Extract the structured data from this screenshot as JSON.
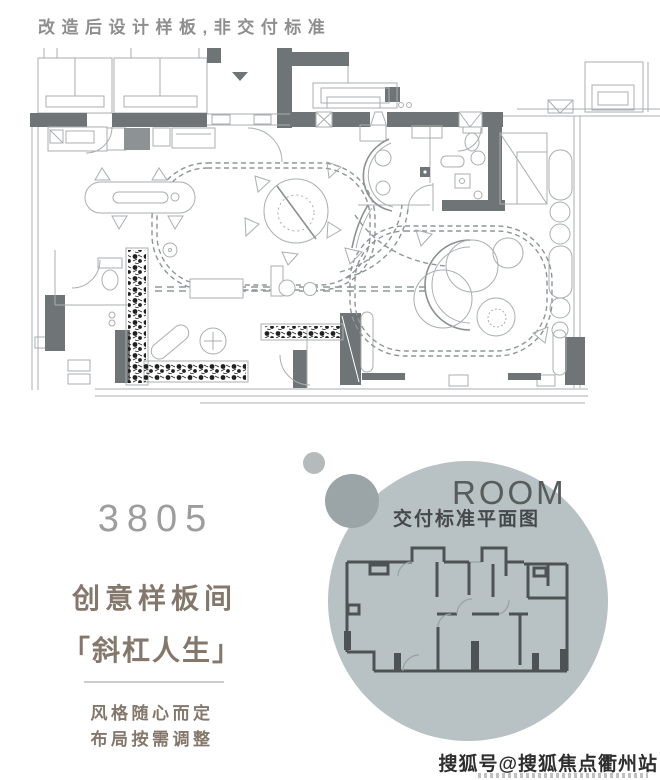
{
  "header": {
    "disclaimer": "改造后设计样板,非交付标准"
  },
  "plan": {
    "description": "renovated-sample-room-floor-plan",
    "entry_marker_icon": "down-arrow"
  },
  "promo": {
    "number": "3805",
    "title": "创意样板间",
    "subtitle": "「斜杠人生」",
    "tagline1": "风格随心而定",
    "tagline2": "布局按需调整"
  },
  "inset": {
    "heading": "ROOM",
    "caption": "交付标准平面图",
    "description": "delivery-standard-floor-plan"
  },
  "watermark": {
    "text": "搜狐号@搜狐焦点衢州站"
  },
  "colors": {
    "header_gray": "#8e8e8e",
    "number_gray": "#9d9d9d",
    "taupe": "#84776b",
    "divider": "#cbcbcb",
    "circle_main": "#b8c1c3",
    "circle_small": "#b5babb",
    "circle_overlap": "#9ba4a6",
    "room_text": "#575c5d",
    "caption_dark": "#45494b",
    "plan_dark": "#6f7476",
    "plan_light": "#a9aeaf",
    "plan_dash": "#8f9596",
    "inset_wall": "#4d5254",
    "plants": "#202020",
    "watermark_ink": "#2e2e2e"
  }
}
